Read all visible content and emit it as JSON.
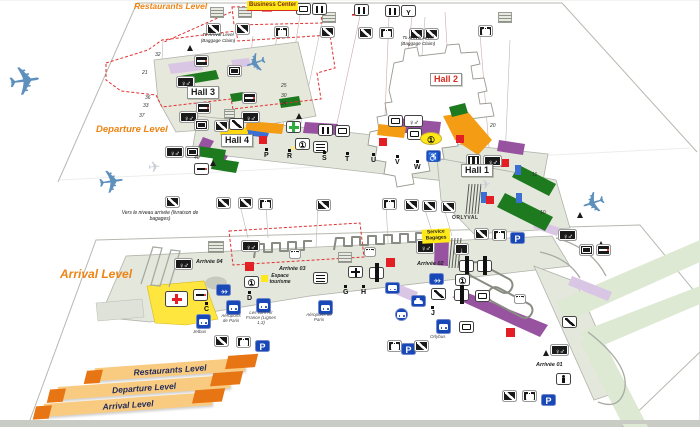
{
  "levels": {
    "restaurants_label": "Restaurants Level",
    "departure_label": "Departure Level",
    "arrival_label": "Arrival Level"
  },
  "legend": {
    "items": [
      "Restaurants Level",
      "Departure Level",
      "Arrival Level"
    ]
  },
  "halls": {
    "h1": "Hall 1",
    "h2": "Hall 2",
    "h3": "Hall 3",
    "h4": "Hall 4"
  },
  "labels": {
    "business_center": "Business Center",
    "to_arrival_a": "To Arrival Level (Baggage Claim)",
    "to_arrival_b": "To Arrival Level (Baggage Claim)",
    "vers_arrivee": "Vers le niveau arrivée (livraison de bagages)",
    "orlyval": "ORLYVAL",
    "service_bagages": "Service Bagages",
    "espace_tourisme": "Espace tourisme",
    "arrivee_01": "Arrivée 01",
    "arrivee_02": "Arrivée 02",
    "arrivee_03": "Arrivée 03",
    "arrivee_04": "Arrivée 04",
    "jetbus": "Jetbus",
    "orlybus": "Orlybus",
    "adp_a": "Aéroports de Paris",
    "adp_b": "Aéroports de Paris",
    "air_france": "Les cars Air France (Lignes 1,3)"
  },
  "doors": {
    "departure": [
      "P",
      "R",
      "S",
      "T",
      "U",
      "V",
      "W"
    ],
    "arrival": [
      "C",
      "D",
      "G",
      "H",
      "J"
    ]
  },
  "gate_numbers": [
    "32",
    "21",
    "36",
    "33",
    "37",
    "40",
    "25",
    "30",
    "24",
    "20",
    "11",
    "10"
  ],
  "icons": {
    "toilets-icon": "male/female restroom figures",
    "escalator-icon": "escalator diagonal",
    "baggage-icon": "suitcase baggage claim",
    "monitor-icon": "flight information screen",
    "restaurant-icon": "fork and knife",
    "bar-icon": "bar glass",
    "smoking-icon": "cigarette smoking area",
    "info-icon": "circled information",
    "parking-icon": "white P on blue",
    "bus-icon": "shuttle bus front",
    "taxi-icon": "car silhouette",
    "transfer-flights-icon": "two airplanes connection",
    "wheelchair-icon": "reduced mobility access",
    "medical-icon": "red first-aid cross",
    "pharmacy-icon": "green cross",
    "meeting-point-icon": "crossed arrows meeting point",
    "counter-icon": "service counter windows",
    "lift-down-icon": "down arrow lift",
    "person-icon": "nursery / waiting figure",
    "plane-icon": "aircraft",
    "stairs-hatch-icon": "hatched stairs block"
  },
  "colors": {
    "level_label_orange": "#EE8312",
    "hall2_red": "#D42B20",
    "highlight_yellow": "#FFE817",
    "shop_purple": "#9853A0",
    "walkway_lavender": "#D9C6E4",
    "zone_orange": "#F59C15",
    "green_dark": "#1E7A1E",
    "pharmacy_green": "#2FAE3C",
    "alert_red": "#E31E24",
    "transport_blue": "#1848B8",
    "terminal_band": "#E4E7DC",
    "pale_green": "#DDE9D2",
    "legend_band_light": "#F9CB81",
    "legend_band_dark": "#E87513"
  }
}
